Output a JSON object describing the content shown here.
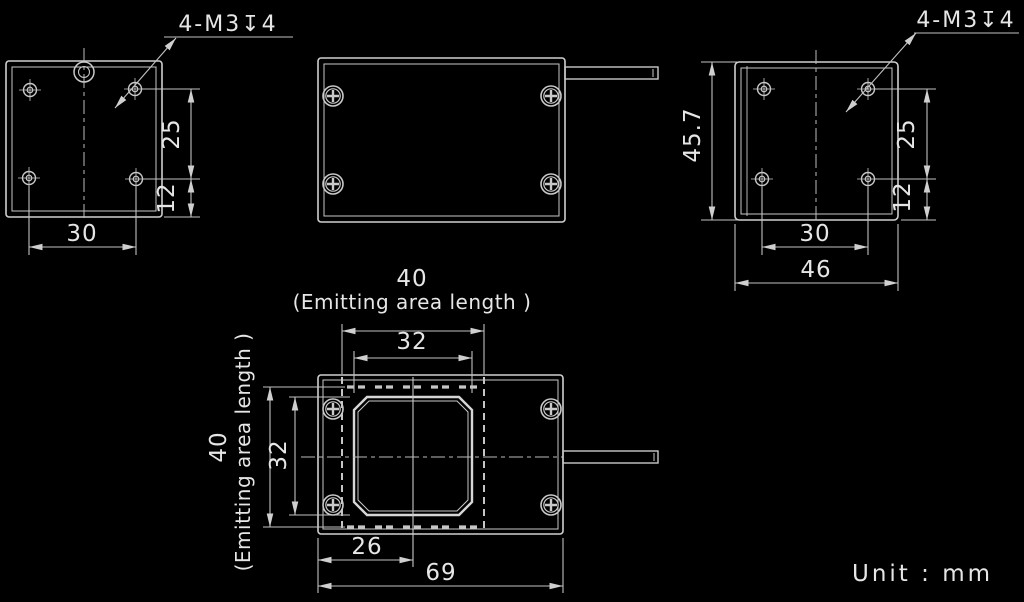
{
  "unit_label": "Unit : mm",
  "colors": {
    "background": "#000000",
    "line": "#cfcfcf",
    "text": "#e6e6e6"
  },
  "views": {
    "left_side": {
      "thread_note": "4-M3↧4",
      "dims": {
        "hole_pitch_v": "25",
        "hole_to_edge": "12",
        "hole_pitch_h": "30"
      }
    },
    "top": {},
    "right_side": {
      "thread_note": "4-M3↧4",
      "dims": {
        "height": "45.7",
        "hole_pitch_v": "25",
        "hole_to_edge": "12",
        "hole_pitch_h": "30",
        "width": "46"
      }
    },
    "front": {
      "dims": {
        "emitting_w": "40",
        "emitting_w_note": "(Emitting area length )",
        "window_w": "32",
        "emitting_h": "40",
        "emitting_h_note": "(Emitting area length )",
        "window_h": "32",
        "center_offset": "26",
        "width": "69"
      }
    }
  }
}
